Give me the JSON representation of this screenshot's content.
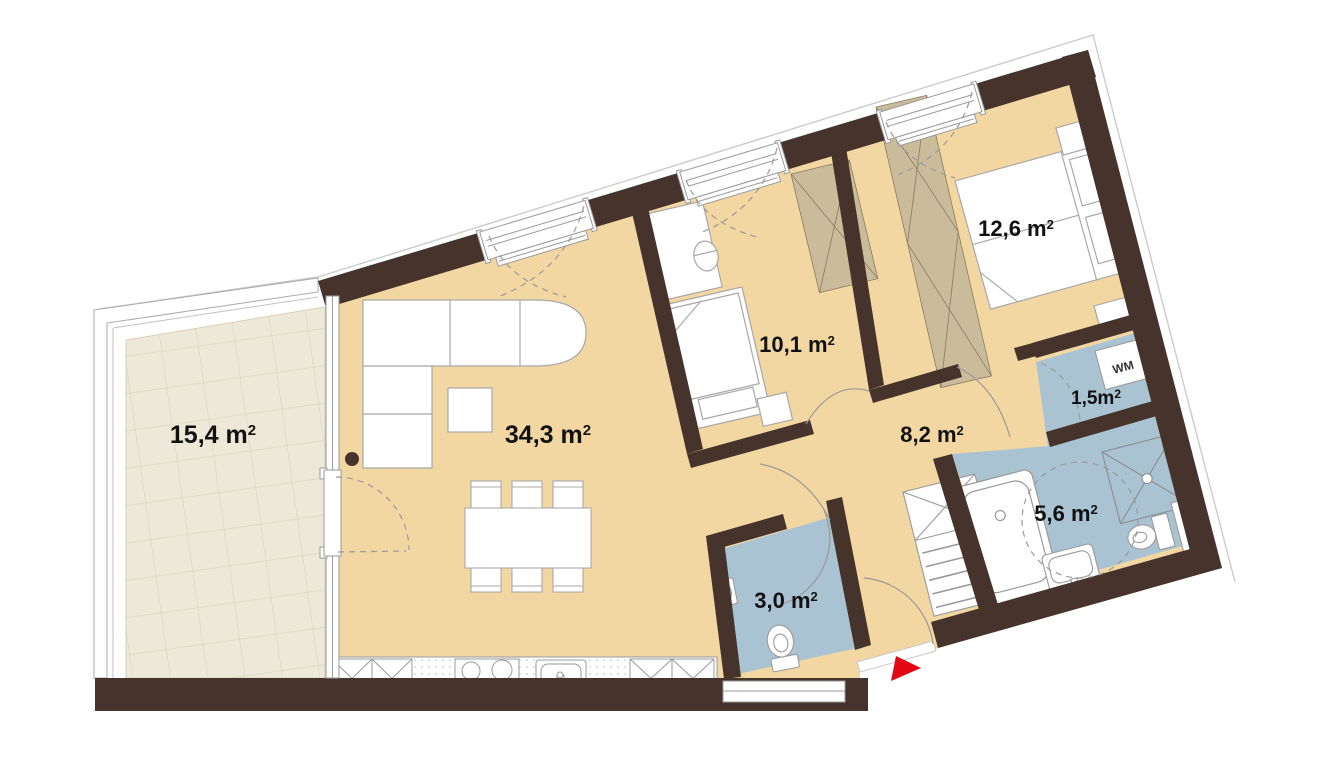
{
  "plan": {
    "kind": "apartment-floor-plan",
    "background": "#ffffff"
  },
  "colors": {
    "wall": "#46342c",
    "floor_main": "#f2d7a2",
    "wet_room": "#a9c3d3",
    "terrace_tile": "#ede9d9",
    "wardrobe_hatch": "#cabb9b",
    "fixture_outline": "#9a9a9a",
    "entrance_marker": "#e30613"
  },
  "rooms": [
    {
      "id": "terrace",
      "area_label": "15,4 m",
      "area_sup": "2"
    },
    {
      "id": "living-kitchen",
      "area_label": "34,3 m",
      "area_sup": "2"
    },
    {
      "id": "bedroom-small",
      "area_label": "10,1 m",
      "area_sup": "2"
    },
    {
      "id": "bedroom-large",
      "area_label": "12,6 m",
      "area_sup": "2"
    },
    {
      "id": "hallway",
      "area_label": "8,2 m",
      "area_sup": "2"
    },
    {
      "id": "utility-room",
      "area_label": "1,5m",
      "area_sup": "2"
    },
    {
      "id": "bathroom",
      "area_label": "5,6 m",
      "area_sup": "2"
    },
    {
      "id": "wc",
      "area_label": "3,0 m",
      "area_sup": "2"
    }
  ],
  "appliances": {
    "washing_machine_label": "WM"
  }
}
